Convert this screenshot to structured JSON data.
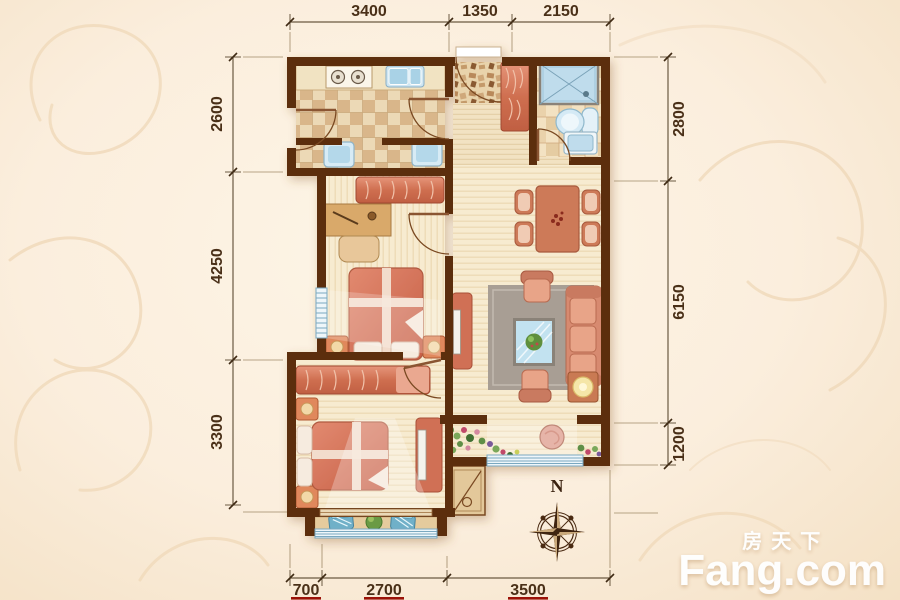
{
  "watermark": {
    "cn": "房天下",
    "en": "Fang.com"
  },
  "compass": {
    "north_label": "N"
  },
  "dimensions": {
    "top": [
      "3400",
      "1350",
      "2150"
    ],
    "left": [
      "2600",
      "4250",
      "3300"
    ],
    "right": [
      "2800",
      "6150",
      "1200"
    ],
    "bottom": [
      "700",
      "2700",
      "3500"
    ]
  },
  "colors": {
    "background": "#fbeeda",
    "wall_brown": "#5c2e10",
    "floor_cream": "#f7ebd0",
    "checker_tan": "#d9b68a",
    "furniture_coral": "#d87a60",
    "fixture_blue": "#bfdcec",
    "window_blue": "#7aa8c0",
    "rug_gray": "#a89e94",
    "dimension_text": "#4a3018",
    "underline_red": "#9b1208",
    "watermark_white": "#ffffff",
    "compass_brown": "#3a2210"
  },
  "rooms": {
    "kitchen": {
      "furniture": [
        "counter",
        "gas-stove",
        "sink",
        "washing-machine",
        "washing-machine"
      ]
    },
    "entry": {
      "furniture": [
        "entry-door",
        "shoe-cabinet"
      ]
    },
    "bathroom": {
      "furniture": [
        "shower",
        "toilet",
        "washbasin"
      ]
    },
    "bedroom_top": {
      "furniture": [
        "wardrobe",
        "desk",
        "chair",
        "double-bed",
        "nightstand",
        "nightstand",
        "window"
      ]
    },
    "living_room": {
      "furniture": [
        "dining-table",
        "dining-chair",
        "dining-chair",
        "dining-chair",
        "dining-chair",
        "tv-cabinet",
        "rug",
        "coffee-table",
        "sofa",
        "armchair",
        "armchair",
        "lamp-table"
      ]
    },
    "flower_bay": {
      "furniture": [
        "flowers",
        "pouf",
        "window"
      ]
    },
    "bedroom_bottom": {
      "furniture": [
        "wardrobe",
        "double-bed",
        "nightstand",
        "nightstand",
        "tv-cabinet"
      ]
    },
    "balcony": {
      "furniture": [
        "lounge-chair",
        "lounge-chair",
        "plant",
        "railing-window"
      ]
    },
    "outside": {
      "furniture": [
        "ac-unit",
        "compass-rose"
      ]
    }
  }
}
